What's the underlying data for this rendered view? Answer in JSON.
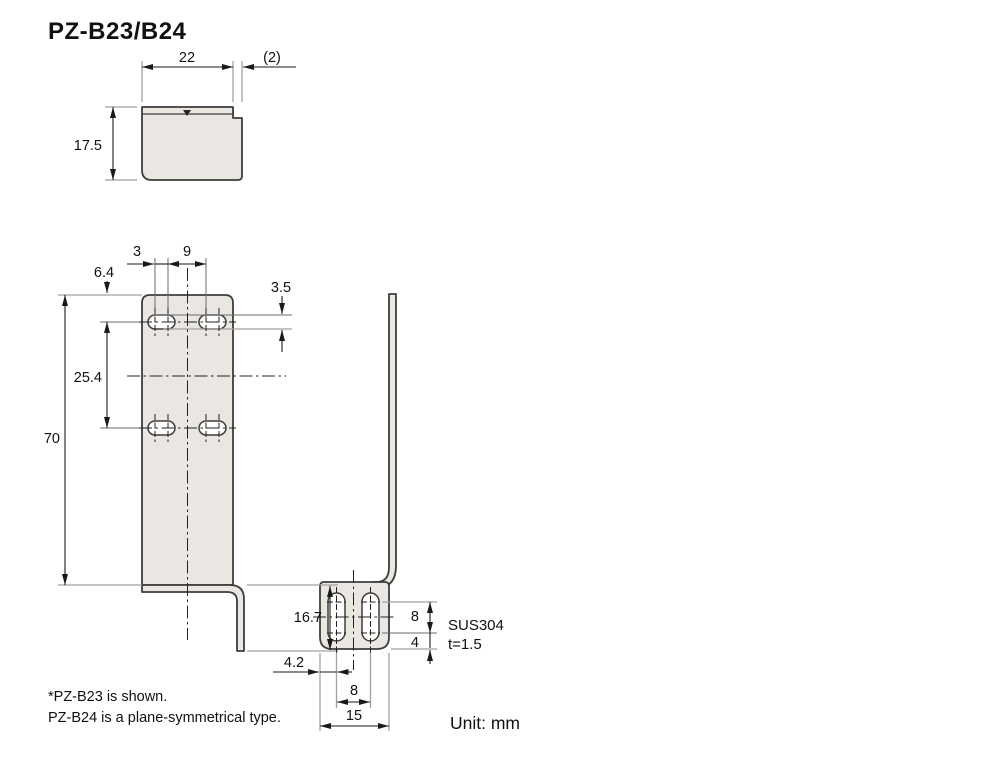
{
  "title": "PZ-B23/B24",
  "unit_label": "Unit: mm",
  "material": {
    "name": "SUS304",
    "thickness": "t=1.5"
  },
  "notes": [
    "*PZ-B23 is shown.",
    " PZ-B24 is a plane-symmetrical type."
  ],
  "colors": {
    "plate_fill": "#eae7e3",
    "outline": "#3f3d3b",
    "extension_line": "#a3a19e",
    "dimension": "#1a1a1a"
  },
  "views": {
    "top": {
      "dims": {
        "width": "22",
        "step": "(2)",
        "depth": "17.5"
      }
    },
    "front": {
      "dims": {
        "slot_arc_pitch": "3",
        "slot_gap": "9",
        "hole_top_offset": "6.4",
        "slot_height": "3.5",
        "row_pitch": "25.4",
        "total_height": "70",
        "lip_height": "16.7"
      }
    },
    "bottom": {
      "dims": {
        "foot_slot_length": "8",
        "foot_edge_margin": "4",
        "foot_slot_offset": "4.2",
        "foot_slot_pitch": "8",
        "foot_width": "15"
      }
    }
  }
}
